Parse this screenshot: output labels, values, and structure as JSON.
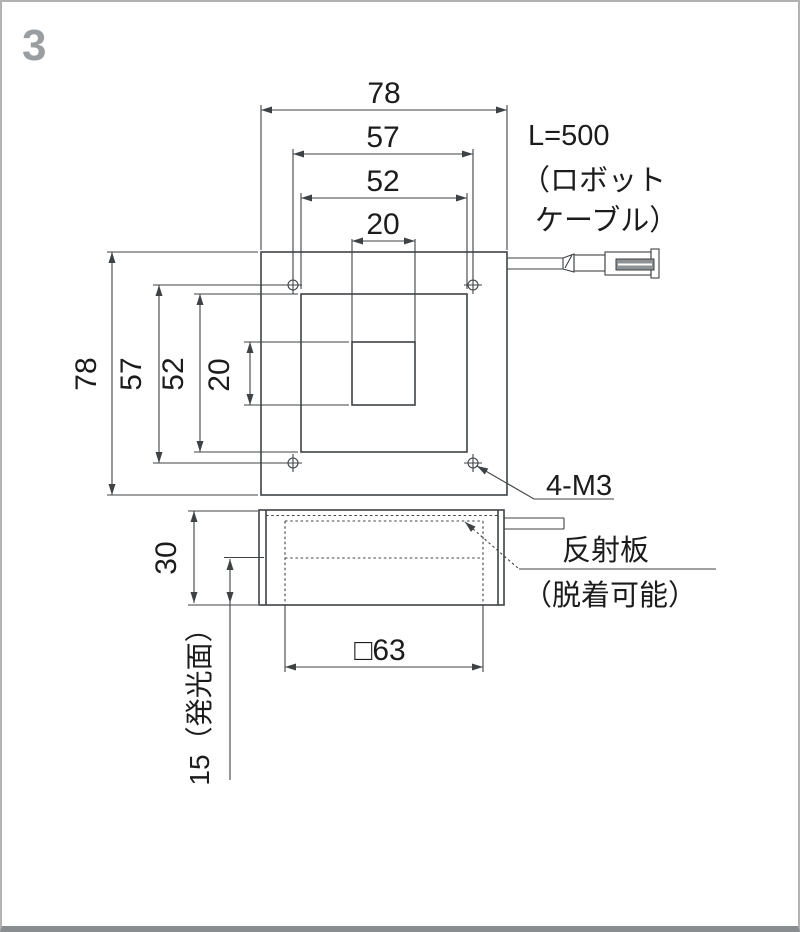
{
  "page": {
    "number": "3"
  },
  "front_view": {
    "top_dims": {
      "d78": "78",
      "d57": "57",
      "d52": "52",
      "d20": "20"
    },
    "left_dims": {
      "d78": "78",
      "d57": "57",
      "d52": "52",
      "d20": "20"
    },
    "screw_callout": "4-M3"
  },
  "cable_note": {
    "line1": "L=500",
    "line2": "（ロボット",
    "line3": "ケーブル）"
  },
  "side_view": {
    "height_dim": "30",
    "emitting_dim": "15（発光面）",
    "square_dim": "□63",
    "reflector_line1": "反射板",
    "reflector_line2": "（脱着可能）"
  },
  "colors": {
    "line": "#3f4245",
    "text": "#1c1c1c",
    "page_number": "#9b9ea0",
    "connector_fill": "#8e9294",
    "border": "#b2b2b2",
    "border_bottom": "#8a8d8f"
  }
}
